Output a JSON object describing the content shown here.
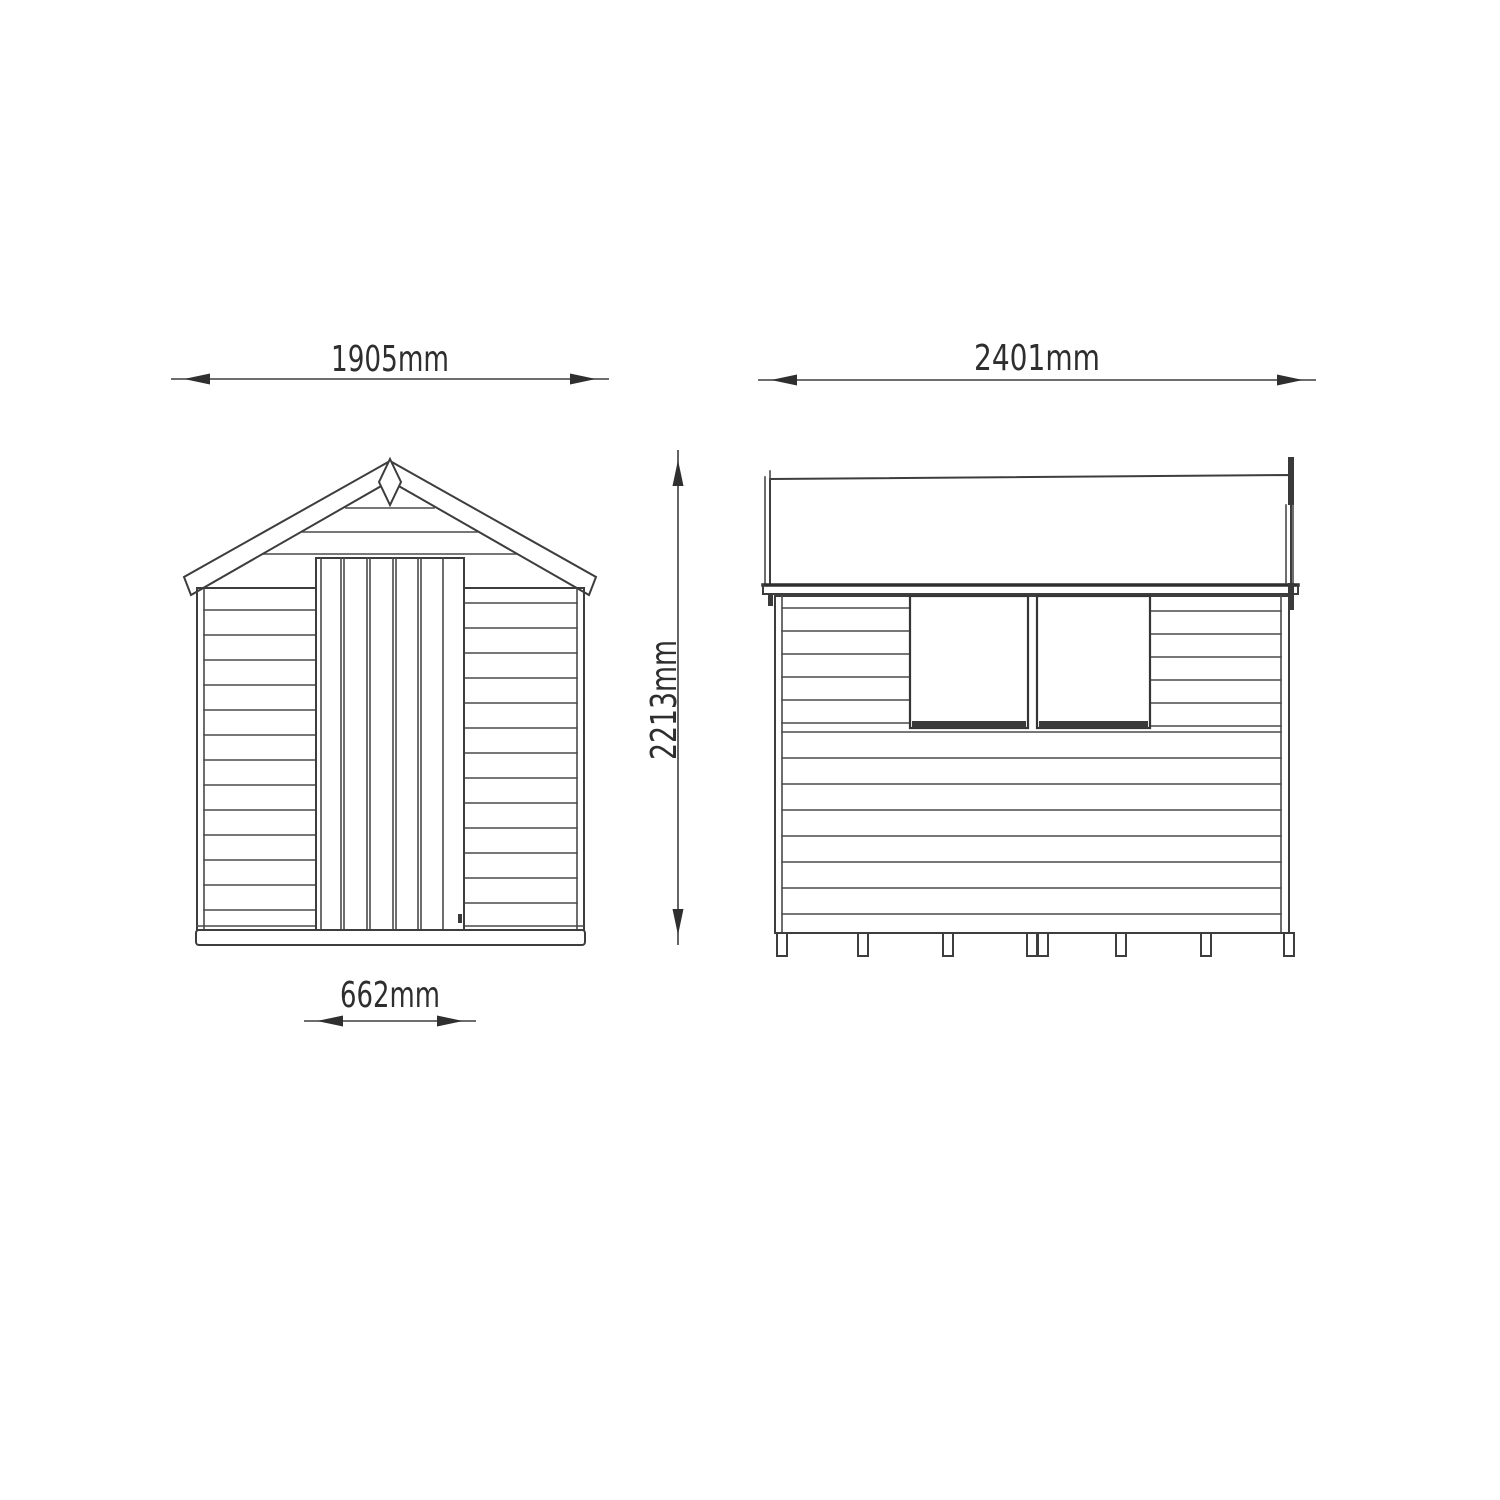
{
  "diagram": {
    "type": "shed-elevation-dimension-drawing",
    "colors": {
      "background": "#ffffff",
      "line": "#3d3d3d",
      "text": "#2e2e2e"
    },
    "dimensions": {
      "front_width": "1905mm",
      "side_length": "2401mm",
      "overall_height": "2213mm",
      "door_width": "662mm"
    }
  }
}
